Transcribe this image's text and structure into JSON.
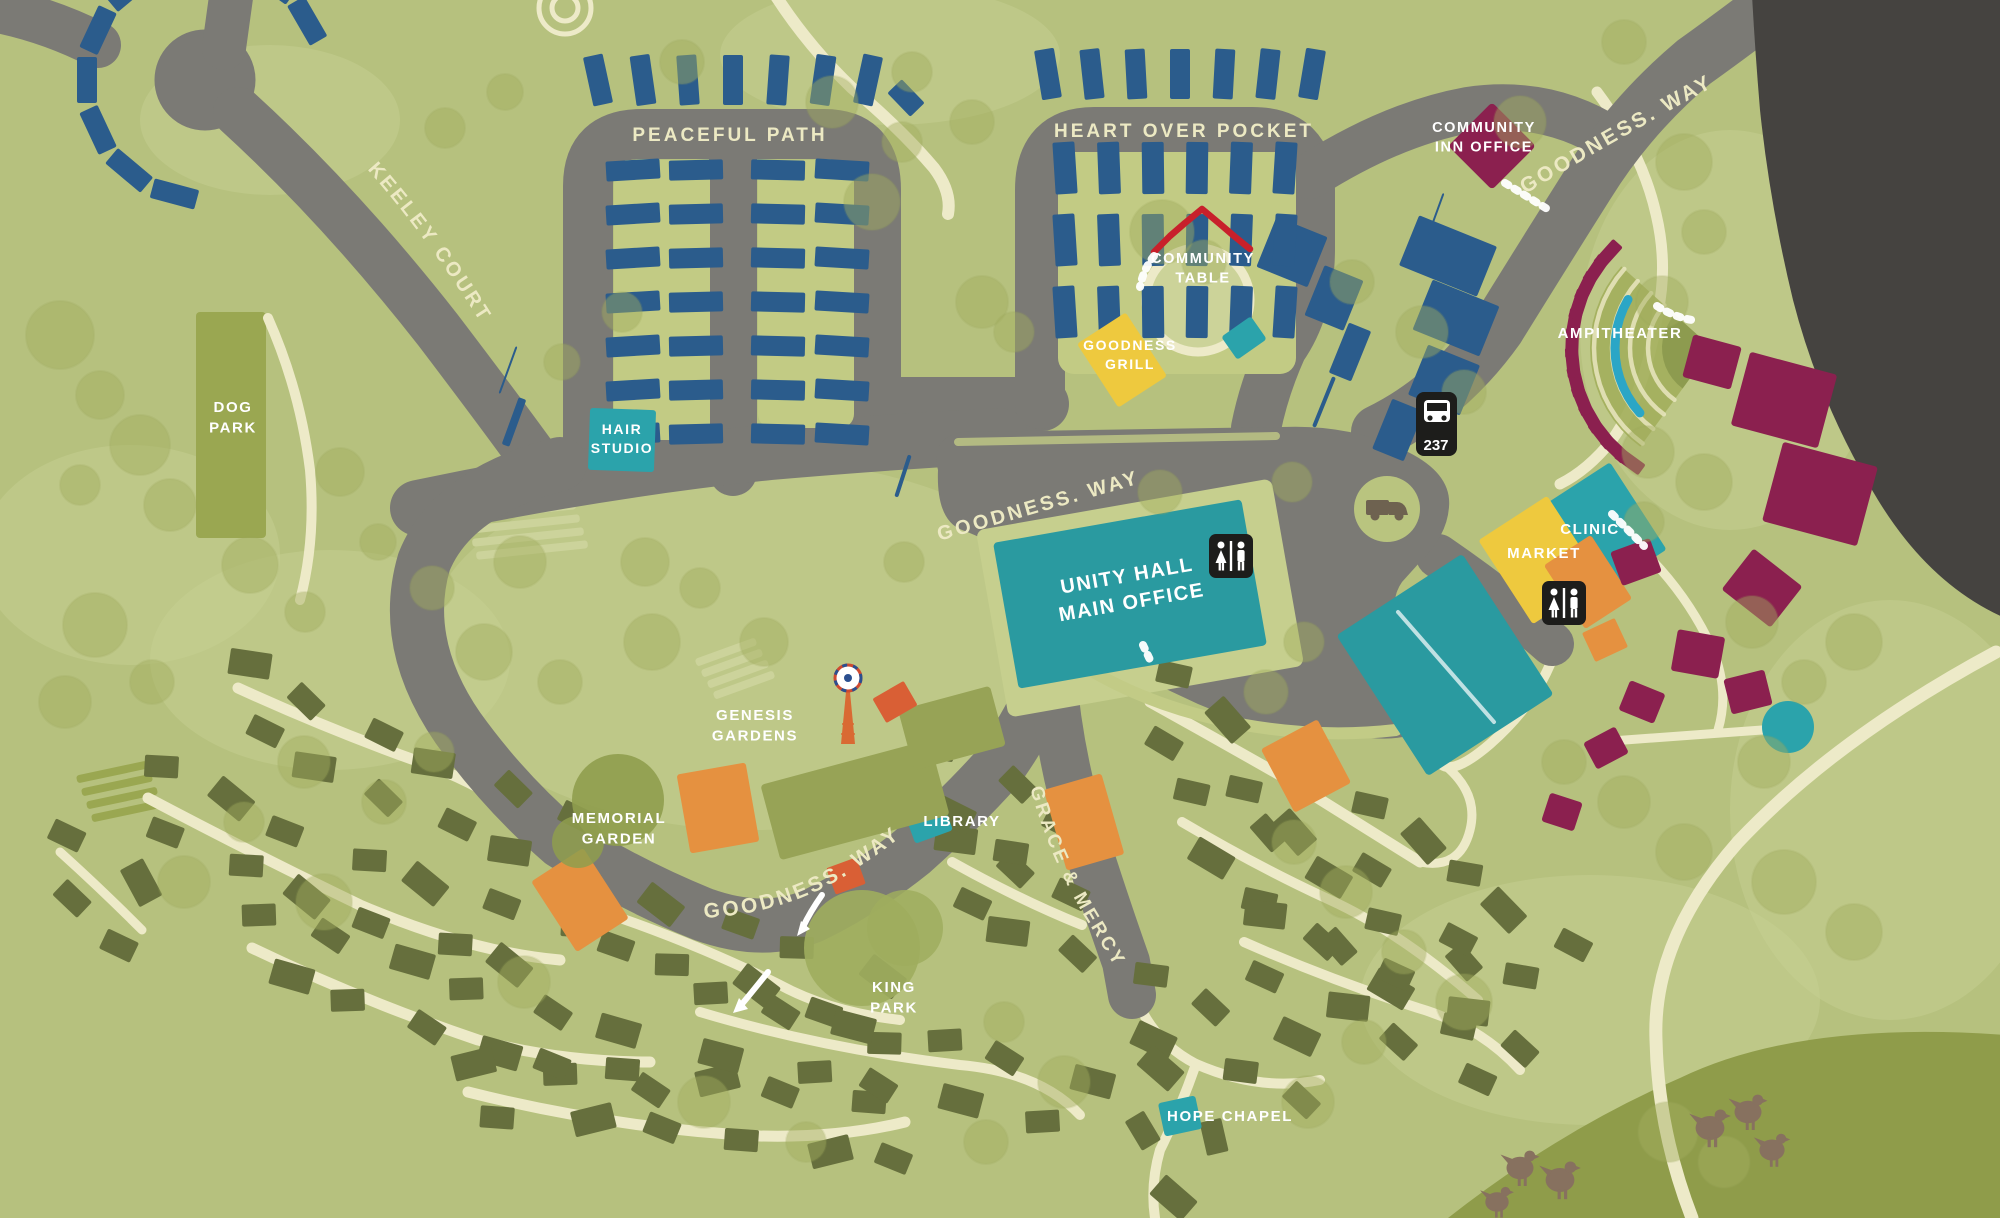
{
  "roads": {
    "peaceful_path": "PEACEFUL PATH",
    "heart_over_pocket": "HEART OVER POCKET",
    "keeley_court": "KEELEY COURT",
    "goodness_way": "GOODNESS. WAY",
    "grace_and_mercy": "GRACE & MERCY"
  },
  "places": {
    "dog_park": [
      "DOG",
      "PARK"
    ],
    "hair_studio": [
      "HAIR",
      "STUDIO"
    ],
    "community_inn_office": [
      "COMMUNITY",
      "INN OFFICE"
    ],
    "community_table": [
      "COMMUNITY",
      "TABLE"
    ],
    "goodness_grill": [
      "GOODNESS",
      "GRILL"
    ],
    "ampitheater": "AMPITHEATER",
    "clinic": "CLINIC",
    "market": "MARKET",
    "unity_hall": [
      "UNITY HALL",
      "MAIN OFFICE"
    ],
    "genesis_gardens": [
      "GENESIS",
      "GARDENS"
    ],
    "memorial_garden": [
      "MEMORIAL",
      "GARDEN"
    ],
    "library": "LIBRARY",
    "king_park": [
      "KING",
      "PARK"
    ],
    "hope_chapel": "HOPE CHAPEL"
  },
  "transit": {
    "bus_route": "237"
  },
  "icons": {
    "bus_stop_icon": "bus glyph on black sign",
    "restroom_icon": "man and woman figures on black square",
    "delivery_truck_icon": "pickup truck in circle",
    "windmill_icon": "orange farm windmill",
    "event_tent_icon": "red canopy roof",
    "chickens_icon": "brown hen silhouettes",
    "one_way_arrow_icon": "white curved arrow"
  },
  "colors": {
    "background": "#b6c17e",
    "road": "#7b7a75",
    "highway": "#454340",
    "path_cream": "#edeac8",
    "homes_blue": "#2b5c8c",
    "homes_olive": "#666f3d",
    "homes_maroon": "#8b204f",
    "civic_teal": "#2ba3ab",
    "unity_teal": "#2a9aa0",
    "market_yellow": "#eec93e",
    "accent_orange": "#e59140",
    "accent_red_orange": "#d95f35",
    "tent_red": "#c8202b",
    "field_olive": "#8f9c4a",
    "label_white": "#ffffff",
    "label_cream": "#ece9c3",
    "sign_black": "#1d1d1b"
  }
}
